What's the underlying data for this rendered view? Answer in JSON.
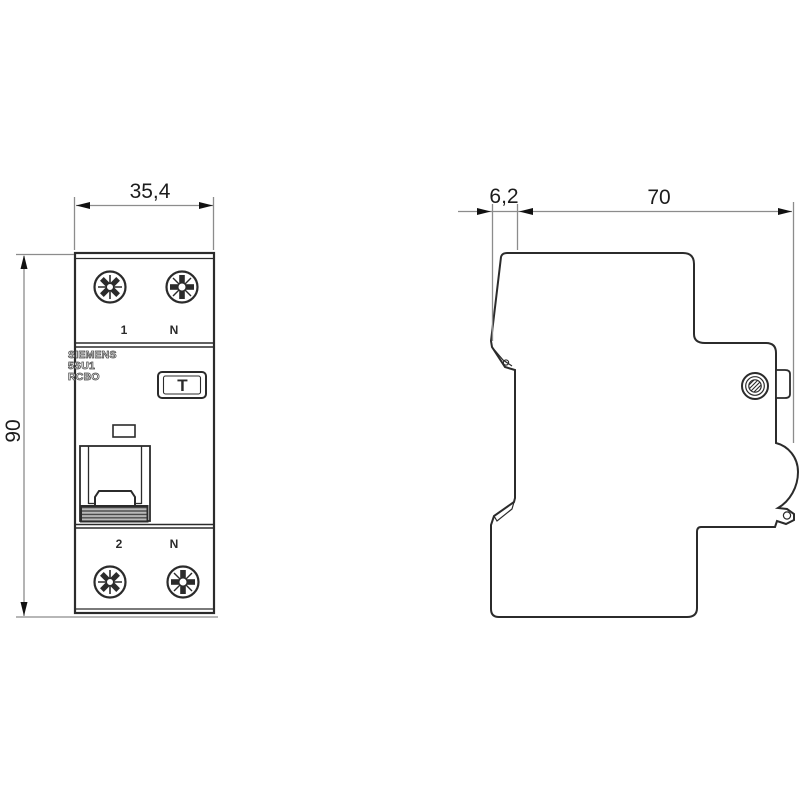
{
  "drawing": {
    "type": "dimensional-drawing",
    "front_view": {
      "brand_lines": [
        "SIEMENS",
        "5SU1",
        "RCBO"
      ],
      "test_button_label": "T",
      "terminals": {
        "top_left": "1",
        "top_right": "N",
        "bottom_left": "2",
        "bottom_right": "N"
      }
    },
    "dimensions": {
      "width_mm": "35,4",
      "height_mm": "90",
      "front_depth_mm": "6,2",
      "body_depth_mm": "70"
    },
    "colors": {
      "background": "#ffffff",
      "outline": "#2b2b2b",
      "dimension_line": "#8c8c8c",
      "arrow": "#111111",
      "dimension_text": "#1c1c1c",
      "toggle_fill": "#b9b9b9",
      "toggle_stripe": "#3f3f3f"
    }
  }
}
